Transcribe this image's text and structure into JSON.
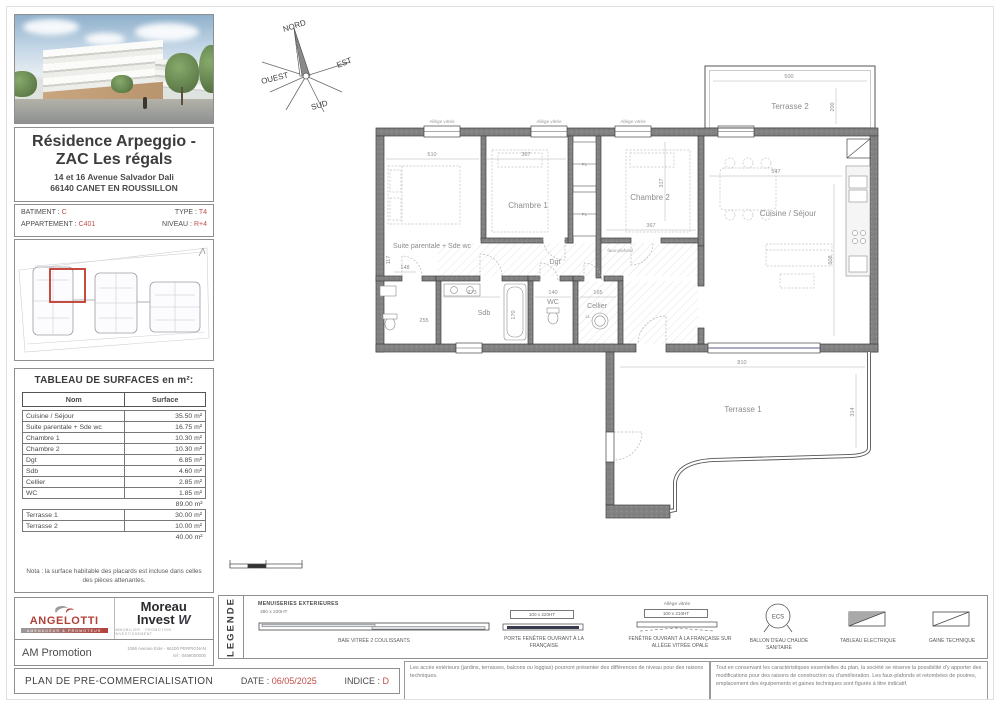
{
  "project": {
    "title_line1": "Résidence Arpeggio -",
    "title_line2": "ZAC Les régals",
    "address_line1": "14 et 16 Avenue Salvador Dali",
    "address_line2": "66140 CANET EN ROUSSILLON"
  },
  "unit": {
    "batiment_label": "BATIMENT :",
    "batiment_value": "C",
    "type_label": "TYPE :",
    "type_value": "T4",
    "appartement_label": "APPARTEMENT :",
    "appartement_value": "C401",
    "niveau_label": "NIVEAU :",
    "niveau_value": "R+4"
  },
  "surfaces": {
    "title": "TABLEAU DE SURFACES en m²:",
    "col_nom": "Nom",
    "col_surface": "Surface",
    "rows": [
      {
        "name": "Cuisine / Séjour",
        "value": "35.50 m²"
      },
      {
        "name": "Suite parentale + Sde wc",
        "value": "16.75 m²"
      },
      {
        "name": "Chambre 1",
        "value": "10.30 m²"
      },
      {
        "name": "Chambre 2",
        "value": "10.30 m²"
      },
      {
        "name": "Dgt",
        "value": "6.85 m²"
      },
      {
        "name": "Sdb",
        "value": "4.60 m²"
      },
      {
        "name": "Cellier",
        "value": "2.85 m²"
      },
      {
        "name": "WC",
        "value": "1.85 m²"
      }
    ],
    "subtotal": "89.00 m²",
    "terrace_rows": [
      {
        "name": "Terrasse 1",
        "value": "30.00 m²"
      },
      {
        "name": "Terrasse 2",
        "value": "10.00 m²"
      }
    ],
    "terrace_total": "40.00 m²",
    "nota": "Nota : la surface habitable des placards est incluse dans celles des pièces attenantes."
  },
  "compass": {
    "nord": "NORD",
    "est": "EST",
    "sud": "SUD",
    "ouest": "OUEST"
  },
  "plan": {
    "rooms": {
      "suite": "Suite parentale + Sde wc",
      "chambre1": "Chambre 1",
      "chambre2": "Chambre 2",
      "cuisine": "Cuisine / Séjour",
      "dgt": "Dgt",
      "sdb": "Sdb",
      "wc": "WC",
      "cellier": "Cellier",
      "terrasse1": "Terrasse 1",
      "terrasse2": "Terrasse 2"
    },
    "annotations": {
      "allege": "Allège vitrée",
      "pl": "PL",
      "ll": "LL",
      "faux_plafond": "faux-plafond"
    },
    "dims": {
      "suite_w": "510",
      "ch1_w": "367",
      "ch2_w": "367",
      "ch2_h": "317",
      "sejour_w": "547",
      "sejour_h": "608",
      "t2_w": "500",
      "t2_h": "200",
      "t1_w": "810",
      "t1_h": "314",
      "sdb_w": "273",
      "wc_w": "140",
      "cellier_w": "165",
      "d117": "117",
      "d148": "148",
      "d255": "255",
      "tub_h": "170"
    }
  },
  "legend": {
    "title": "LEGENDE",
    "menuiseries": "MENUISERIES EXTERIEURES",
    "bay_dim": "380 x 220HT",
    "bay_label": "BAIE VITRÉE 2 COULISSANTS",
    "pf_dim": "100 x 220HT",
    "pf_label": "PORTE FENÊTRE OUVRANT À LA FRANÇAISE",
    "fen_pre": "Allège vitrée",
    "fen_dim": "100 x 210HT",
    "fen_label": "FENÊTRE OUVRANT À LA FRANÇAISE SUR ALLÈGE VITRÉE OPALE",
    "ecs_abbr": "ECS",
    "ecs_label": "BALLON D'EAU CHAUDE SANITAIRE",
    "tableau_label": "TABLEAU ELECTRIQUE",
    "gaine_label": "GAINE TECHNIQUE"
  },
  "branding": {
    "angelotti": "ANGELOTTI",
    "angelotti_tagline": "AMÉNAGEUR & PROMOTEUR",
    "moreau_1": "Moreau",
    "moreau_2": "Invest",
    "moreau_mark": "W",
    "moreau_tagline": "IMMOBILIER · PROMOTION · INVESTISSEMENT",
    "am": "AM Promotion",
    "address": "1066 Avenue Eole - 66100 PERPIGNAN",
    "tel": "tel : 0468000000"
  },
  "footer": {
    "plan_title": "PLAN DE PRE-COMMERCIALISATION",
    "date_label": "DATE :",
    "date_value": "06/05/2025",
    "indice_label": "INDICE :",
    "indice_value": "D"
  },
  "disclaimers": {
    "d1": "Les accès extérieurs (jardins, terrasses, balcons ou loggias) pourront présenter des différences de niveau pour des raisons techniques.",
    "d2": "Tout en conservant les caractéristiques essentielles du plan, la société se réserve la possibilité d'y apporter des modifications pour des raisons de construction ou d'amélioration. Les faux-plafonds et retombées de poutres, emplacement des équipements et gaines techniques sont figurés à titre indicatif."
  },
  "colors": {
    "accent_red": "#bf4e48",
    "wall_gray": "#7d7d7d"
  }
}
